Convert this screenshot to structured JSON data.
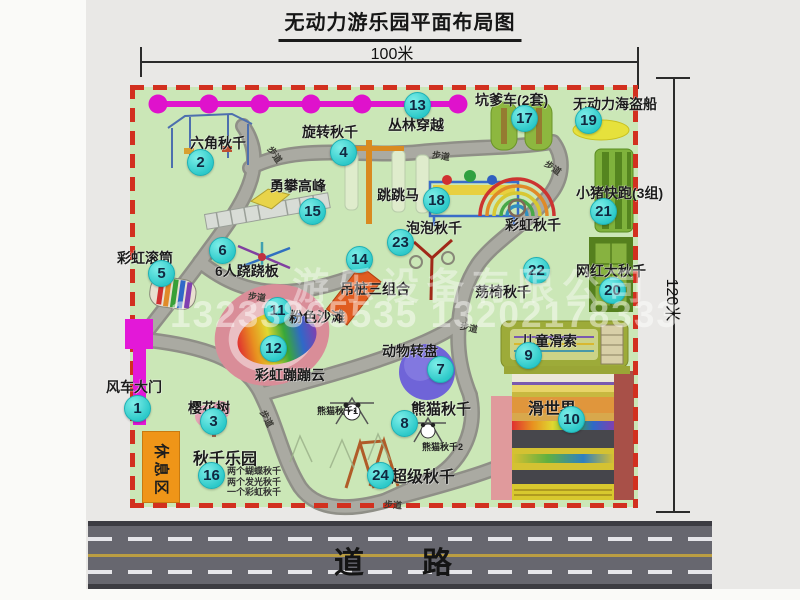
{
  "title": "无动力游乐园平面布局图",
  "dim_width": "100米",
  "dim_height": "120米",
  "road": "道　路",
  "rest_area": "休息区",
  "watermark": {
    "company": "游乐设备有限公司",
    "phone": "13233865535 13202178333"
  },
  "walkway_labels": {
    "text": "步道",
    "positions": [
      {
        "x": 266,
        "y": 148,
        "r": 55
      },
      {
        "x": 432,
        "y": 149,
        "r": 8
      },
      {
        "x": 544,
        "y": 161,
        "r": 35
      },
      {
        "x": 248,
        "y": 290,
        "r": 8
      },
      {
        "x": 460,
        "y": 321,
        "r": 12
      },
      {
        "x": 258,
        "y": 412,
        "r": 62
      },
      {
        "x": 384,
        "y": 498,
        "r": 4
      }
    ]
  },
  "attractions": [
    {
      "n": "1",
      "label": "风车大门",
      "lx": 106,
      "ly": 377,
      "nx": 137,
      "ny": 408
    },
    {
      "n": "2",
      "label": "六角秋千",
      "lx": 190,
      "ly": 133,
      "nx": 200,
      "ny": 162
    },
    {
      "n": "3",
      "label": "樱花树",
      "lx": 188,
      "ly": 398,
      "nx": 213,
      "ny": 421
    },
    {
      "n": "4",
      "label": "旋转秋千",
      "lx": 302,
      "ly": 122,
      "nx": 343,
      "ny": 152
    },
    {
      "n": "5",
      "label": "彩虹滚筒",
      "lx": 117,
      "ly": 248,
      "nx": 161,
      "ny": 273
    },
    {
      "n": "6",
      "label": "6人跷跷板",
      "lx": 215,
      "ly": 261,
      "nx": 222,
      "ny": 250
    },
    {
      "n": "7",
      "label": "动物转盘",
      "lx": 382,
      "ly": 341,
      "nx": 440,
      "ny": 369
    },
    {
      "n": "8",
      "label": "熊猫秋千",
      "lx": 411,
      "ly": 398,
      "nx": 404,
      "ny": 423,
      "fs": 15
    },
    {
      "n": "9",
      "label": "儿童滑索",
      "lx": 521,
      "ly": 331,
      "nx": 528,
      "ny": 355
    },
    {
      "n": "10",
      "label": "滑世界",
      "lx": 528,
      "ly": 395,
      "nx": 571,
      "ny": 419,
      "fs": 16
    },
    {
      "n": "11",
      "label": "粉色沙滩",
      "lx": 289,
      "ly": 307,
      "nx": 277,
      "ny": 310
    },
    {
      "n": "12",
      "label": "彩虹蹦蹦云",
      "lx": 255,
      "ly": 365,
      "nx": 273,
      "ny": 348
    },
    {
      "n": "13",
      "label": "丛林穿越",
      "lx": 388,
      "ly": 115,
      "nx": 417,
      "ny": 105
    },
    {
      "n": "14",
      "label": "吊桩三组合",
      "lx": 340,
      "ly": 279,
      "nx": 359,
      "ny": 259
    },
    {
      "n": "15",
      "label": "勇攀高峰",
      "lx": 270,
      "ly": 176,
      "nx": 312,
      "ny": 211
    },
    {
      "n": "16",
      "label": "秋千乐园",
      "lx": 193,
      "ly": 445,
      "nx": 211,
      "ny": 475,
      "fs": 16
    },
    {
      "n": "17",
      "label": "坑爹车(2套)",
      "lx": 475,
      "ly": 90,
      "nx": 524,
      "ny": 118
    },
    {
      "n": "18",
      "label": "跳跳马",
      "lx": 377,
      "ly": 185,
      "nx": 436,
      "ny": 200
    },
    {
      "n": "19",
      "label": "无动力海盗船",
      "lx": 573,
      "ly": 94,
      "nx": 588,
      "ny": 120
    },
    {
      "n": "20",
      "label": "网红大秋千",
      "lx": 576,
      "ly": 261,
      "nx": 612,
      "ny": 290
    },
    {
      "n": "21",
      "label": "小猪快跑(3组)",
      "lx": 576,
      "ly": 183,
      "nx": 603,
      "ny": 211
    },
    {
      "n": "22",
      "label": "荡椅秋千",
      "lx": 475,
      "ly": 282,
      "nx": 536,
      "ny": 270
    },
    {
      "n": "23",
      "label": "泡泡秋千",
      "lx": 406,
      "ly": 218,
      "nx": 400,
      "ny": 242
    },
    {
      "n": "24",
      "label": "超级秋千",
      "lx": 391,
      "ly": 463,
      "nx": 380,
      "ny": 475,
      "fs": 16
    }
  ],
  "extra_labels": [
    {
      "text": "彩虹秋千",
      "x": 505,
      "y": 215,
      "fs": 14
    },
    {
      "text": "熊猫秋千1",
      "x": 317,
      "y": 404,
      "fs": 9
    },
    {
      "text": "熊猫秋千2",
      "x": 422,
      "y": 440,
      "fs": 9
    }
  ],
  "swing_park_details": {
    "x": 227,
    "y": 464,
    "lines": [
      "两个蝴蝶秋千",
      "两个发光秋千",
      "一个彩虹秋千"
    ]
  }
}
